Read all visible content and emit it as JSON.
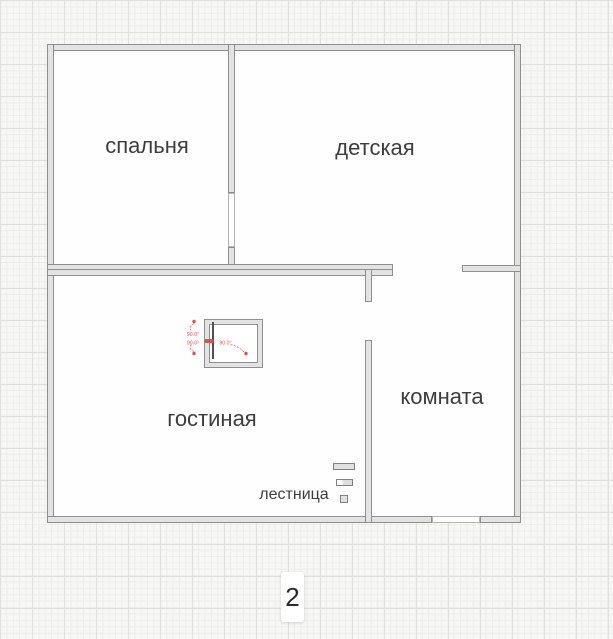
{
  "floor_selector": {
    "current_floor": "2"
  },
  "rooms": [
    {
      "name": "спальня"
    },
    {
      "name": "детская"
    },
    {
      "name": "гостиная"
    },
    {
      "name": "комната"
    }
  ],
  "objects": {
    "stairs_label": "лестница"
  },
  "annotations": {
    "angle_1": "90.0°",
    "angle_2": "90.0°",
    "angle_3": "90.0°"
  },
  "colors": {
    "background": "#f7f7f5",
    "grid_minor": "#ededeb",
    "grid_major": "#e0e0de",
    "room_fill": "#fefefe",
    "wall_fill": "#e3e3e3",
    "wall_border": "#8f8f8f",
    "door_fill": "#ffffff",
    "annotation_red": "#e25050",
    "label_text": "#3d3d3d"
  }
}
